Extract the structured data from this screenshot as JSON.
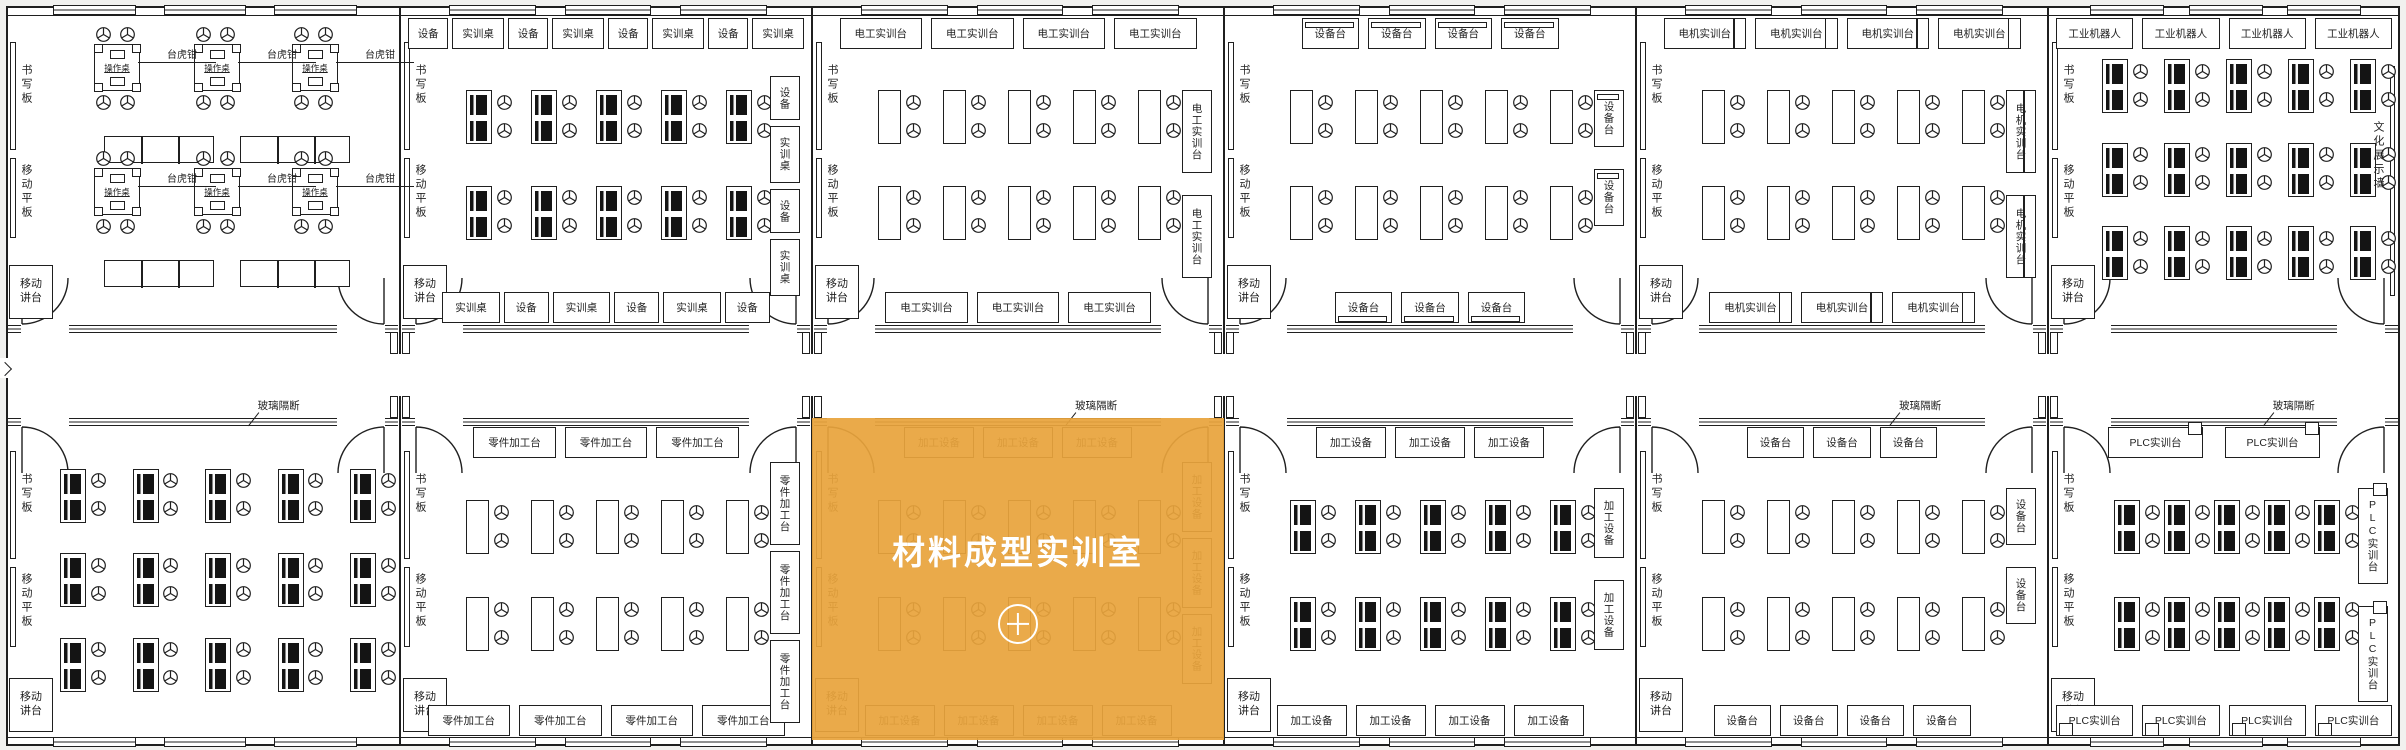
{
  "plan_title": "实训室平面图",
  "common": {
    "writing_board": "书写板",
    "mobile_panel": "移动平板",
    "mobile_lectern": "移动讲台",
    "glass_partition": "玻璃隔断",
    "vise_label": "台虎钳",
    "bench_label": "操作桌"
  },
  "colors": {
    "highlight": "#E6A23C",
    "highlight_text": "#ffffff",
    "line": "#1f1f1f",
    "outside_bg": "#f1f1ef",
    "room_bg": "#ffffff"
  },
  "rooms": [
    {
      "position": "top-1",
      "furniture": "bench",
      "bench_count": 6,
      "table_count": 4,
      "left_wall_items": true
    },
    {
      "position": "top-2",
      "furniture": "monitor-desk",
      "desk_rows": 2,
      "desk_cols": 5,
      "left_wall_items": true,
      "top_boxes": [
        "设备",
        "实训桌",
        "设备",
        "实训桌",
        "设备",
        "实训桌",
        "设备",
        "实训桌"
      ],
      "right_boxes": [
        "设备",
        "实训桌",
        "设备",
        "实训桌"
      ],
      "bottom_boxes": [
        "实训桌",
        "设备",
        "实训桌",
        "设备",
        "实训桌",
        "设备"
      ]
    },
    {
      "position": "top-3",
      "furniture": "plain-desk",
      "desk_rows": 2,
      "desk_cols": 5,
      "left_wall_items": true,
      "top_boxes": [
        "电工实训台",
        "电工实训台",
        "电工实训台",
        "电工实训台"
      ],
      "right_boxes": [
        "电工实训台",
        "电工实训台"
      ],
      "bottom_boxes": [
        "电工实训台",
        "电工实训台",
        "电工实训台"
      ]
    },
    {
      "position": "top-4",
      "furniture": "plain-desk",
      "desk_rows": 2,
      "desk_cols": 5,
      "left_wall_items": true,
      "box_variant": "bar",
      "top_boxes": [
        "设备台",
        "设备台",
        "设备台",
        "设备台"
      ],
      "right_boxes": [
        "设备台",
        "设备台"
      ],
      "bottom_boxes": [
        "设备台",
        "设备台",
        "设备台"
      ]
    },
    {
      "position": "top-5",
      "furniture": "plain-desk",
      "desk_rows": 2,
      "desk_cols": 5,
      "left_wall_items": true,
      "box_variant": "split",
      "top_boxes": [
        "电机实训台",
        "电机实训台",
        "电机实训台",
        "电机实训台"
      ],
      "right_boxes": [
        "电机实训台",
        "电机实训台"
      ],
      "bottom_boxes": [
        "电机实训台",
        "电机实训台",
        "电机实训台"
      ]
    },
    {
      "position": "top-6",
      "furniture": "monitor-desk",
      "desk_rows": 3,
      "desk_cols": 5,
      "left_wall_items": true,
      "top_boxes": [
        "工业机器人",
        "工业机器人",
        "工业机器人",
        "工业机器人"
      ],
      "right_wall_text": "文化展示墙"
    },
    {
      "position": "bottom-1",
      "furniture": "monitor-desk",
      "desk_rows": 3,
      "desk_cols": 5,
      "left_wall_items": true,
      "glass_partition": true
    },
    {
      "position": "bottom-2",
      "furniture": "plain-desk",
      "desk_rows": 2,
      "desk_cols": 5,
      "left_wall_items": true,
      "top_boxes": [
        "零件加工台",
        "零件加工台",
        "零件加工台"
      ],
      "right_boxes": [
        "零件加工台",
        "零件加工台",
        "零件加工台"
      ],
      "bottom_boxes": [
        "零件加工台",
        "零件加工台",
        "零件加工台",
        "零件加工台"
      ]
    },
    {
      "position": "bottom-3",
      "furniture": "plain-desk",
      "desk_rows": 2,
      "desk_cols": 5,
      "left_wall_items": true,
      "glass_partition": true,
      "top_boxes": [
        "加工设备",
        "加工设备",
        "加工设备"
      ],
      "right_boxes": [
        "加工设备",
        "加工设备",
        "加工设备"
      ],
      "bottom_boxes": [
        "加工设备",
        "加工设备",
        "加工设备",
        "加工设备"
      ],
      "highlight": {
        "label": "材料成型实训室",
        "icon": "plus-icon",
        "color": "#E6A23C"
      }
    },
    {
      "position": "bottom-4",
      "furniture": "monitor-desk",
      "desk_rows": 2,
      "desk_cols": 5,
      "left_wall_items": true,
      "top_boxes": [
        "加工设备",
        "加工设备",
        "加工设备"
      ],
      "right_boxes": [
        "加工设备",
        "加工设备"
      ],
      "bottom_boxes": [
        "加工设备",
        "加工设备",
        "加工设备",
        "加工设备"
      ]
    },
    {
      "position": "bottom-5",
      "furniture": "plain-desk",
      "desk_rows": 2,
      "desk_cols": 5,
      "left_wall_items": true,
      "glass_partition": true,
      "top_boxes": [
        "设备台",
        "设备台",
        "设备台"
      ],
      "right_boxes": [
        "设备台",
        "设备台"
      ],
      "bottom_boxes": [
        "设备台",
        "设备台",
        "设备台",
        "设备台"
      ]
    },
    {
      "position": "bottom-6",
      "furniture": "monitor-desk",
      "desk_rows": 2,
      "desk_cols": 5,
      "left_wall_items": true,
      "glass_partition": true,
      "box_variant": "tag",
      "top_boxes": [
        "PLC实训台",
        "PLC实训台"
      ],
      "right_boxes": [
        "PLC实训台",
        "PLC实训台"
      ],
      "bottom_boxes": [
        "PLC实训台",
        "PLC实训台",
        "PLC实训台",
        "PLC实训台"
      ]
    }
  ]
}
